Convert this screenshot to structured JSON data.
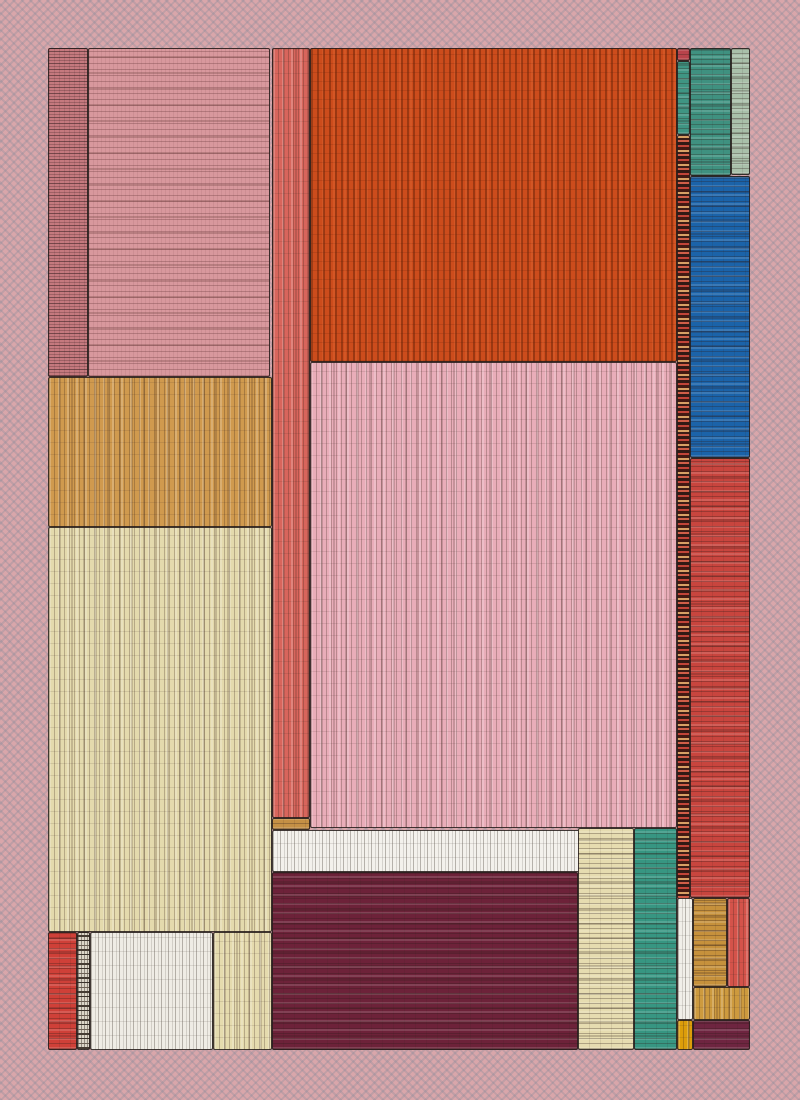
{
  "artwork": {
    "description": "Abstract hand-drawn textured treemap composition of nested rectangles on a dotted dusty-pink ground",
    "canvas": {
      "width": 800,
      "height": 1100
    },
    "frame": {
      "x": 48,
      "y": 48,
      "width": 702,
      "height": 1002
    },
    "palette": {
      "background": "#d9a6aa",
      "background_dot": "#8d97a6",
      "outline": "#2a211e",
      "rose": "#c5797e",
      "dusty_pink": "#d8989d",
      "salmon": "#d8655c",
      "orange": "#cc4c1c",
      "light_pink": "#e9adb9",
      "tan": "#d09a4e",
      "cream": "#e4daad",
      "teal": "#3f9180",
      "sage": "#a9c0aa",
      "blue": "#1b63a9",
      "red": "#c8453e",
      "maroon": "#6d2239",
      "white": "#f3f1ec",
      "ochre": "#c6913c",
      "gold": "#dc9d0a"
    },
    "blocks": [
      {
        "name": "rose-scribble-strip",
        "x": 0,
        "y": 0,
        "w": 40,
        "h": 329,
        "color": "#c5797e",
        "texture": "tex-hs"
      },
      {
        "name": "dusty-pink-block",
        "x": 40,
        "y": 0,
        "w": 182,
        "h": 329,
        "color": "#d8989d",
        "texture": "tex-hl"
      },
      {
        "name": "tan-block",
        "x": 0,
        "y": 329,
        "w": 224,
        "h": 150,
        "color": "#d09a4e",
        "texture": "tex-v"
      },
      {
        "name": "cream-block",
        "x": 0,
        "y": 479,
        "w": 224,
        "h": 405,
        "color": "#e4daad",
        "texture": "tex-v"
      },
      {
        "name": "red-bottom-left-block",
        "x": 0,
        "y": 884,
        "w": 29,
        "h": 118,
        "color": "#cf4038",
        "texture": "tex-h"
      },
      {
        "name": "speckle-gray-strip",
        "x": 29,
        "y": 884,
        "w": 13,
        "h": 118,
        "color": "#ddd6c9",
        "texture": "tex-speckle-gray"
      },
      {
        "name": "white-bottom-left-block",
        "x": 42,
        "y": 884,
        "w": 123,
        "h": 118,
        "color": "#efece5",
        "texture": "tex-vs"
      },
      {
        "name": "cream-bottom-left-block",
        "x": 165,
        "y": 884,
        "w": 59,
        "h": 118,
        "color": "#e5dbae",
        "texture": "tex-v"
      },
      {
        "name": "salmon-strip",
        "x": 224,
        "y": 0,
        "w": 38,
        "h": 770,
        "color": "#d8655c",
        "texture": "tex-v"
      },
      {
        "name": "ochre-mini-block",
        "x": 224,
        "y": 770,
        "w": 38,
        "h": 12,
        "color": "#c59045",
        "texture": "tex-h"
      },
      {
        "name": "orange-field",
        "x": 262,
        "y": 0,
        "w": 367,
        "h": 314,
        "color": "#cc4c1c",
        "texture": "tex-v-strong"
      },
      {
        "name": "pink-field",
        "x": 262,
        "y": 314,
        "w": 367,
        "h": 466,
        "color": "#e9adb9",
        "texture": "tex-v"
      },
      {
        "name": "white-middle-strip",
        "x": 224,
        "y": 782,
        "w": 309,
        "h": 42,
        "color": "#f3f1ec",
        "texture": "tex-vs"
      },
      {
        "name": "maroon-field",
        "x": 224,
        "y": 824,
        "w": 306,
        "h": 178,
        "color": "#6d2239",
        "texture": "tex-h"
      },
      {
        "name": "cream-column",
        "x": 530,
        "y": 780,
        "w": 56,
        "h": 222,
        "color": "#e6dcb0",
        "texture": "tex-h"
      },
      {
        "name": "teal-column",
        "x": 586,
        "y": 780,
        "w": 43,
        "h": 222,
        "color": "#379682",
        "texture": "tex-h"
      },
      {
        "name": "red-top-mini-block",
        "x": 629,
        "y": 0,
        "w": 13,
        "h": 13,
        "color": "#b8434b",
        "texture": "tex-h"
      },
      {
        "name": "teal-narrow-strip",
        "x": 629,
        "y": 13,
        "w": 13,
        "h": 74,
        "color": "#3f9583",
        "texture": "tex-h"
      },
      {
        "name": "speckle-warm-spine",
        "x": 629,
        "y": 87,
        "w": 13,
        "h": 764,
        "color": "#6b3026",
        "texture": "tex-speckle-warm"
      },
      {
        "name": "teal-top-block",
        "x": 642,
        "y": 0,
        "w": 41,
        "h": 128,
        "color": "#3f9180",
        "texture": "tex-h"
      },
      {
        "name": "sage-top-strip",
        "x": 683,
        "y": 0,
        "w": 19,
        "h": 127,
        "color": "#a9c0aa",
        "texture": "tex-h"
      },
      {
        "name": "blue-block",
        "x": 642,
        "y": 128,
        "w": 60,
        "h": 282,
        "color": "#1b63a9",
        "texture": "tex-h"
      },
      {
        "name": "red-right-block",
        "x": 642,
        "y": 410,
        "w": 60,
        "h": 440,
        "color": "#c8453e",
        "texture": "tex-h"
      },
      {
        "name": "white-bottom-right-column",
        "x": 629,
        "y": 850,
        "w": 16,
        "h": 122,
        "color": "#f1efe9",
        "texture": "tex-vs"
      },
      {
        "name": "ochre-bottom-right-block",
        "x": 645,
        "y": 850,
        "w": 34,
        "h": 89,
        "color": "#c6913c",
        "texture": "tex-h"
      },
      {
        "name": "red-bottom-right-column",
        "x": 679,
        "y": 850,
        "w": 23,
        "h": 89,
        "color": "#d4534a",
        "texture": "tex-v"
      },
      {
        "name": "ochre-wide-block",
        "x": 645,
        "y": 939,
        "w": 57,
        "h": 33,
        "color": "#cd9a3e",
        "texture": "tex-v"
      },
      {
        "name": "gold-mini-block",
        "x": 629,
        "y": 972,
        "w": 16,
        "h": 30,
        "color": "#dc9d0a",
        "texture": "tex-v"
      },
      {
        "name": "maroon-bottom-right-block",
        "x": 645,
        "y": 972,
        "w": 57,
        "h": 30,
        "color": "#6e2540",
        "texture": "tex-h"
      }
    ]
  }
}
